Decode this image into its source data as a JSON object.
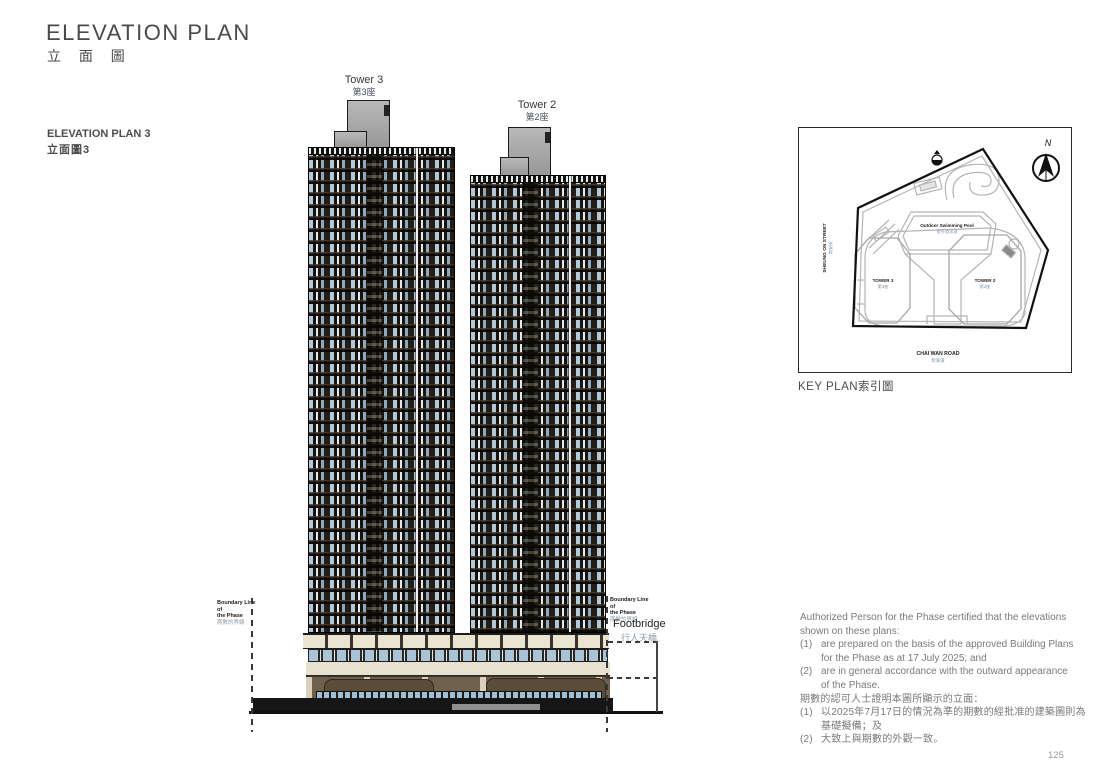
{
  "page": {
    "title": "ELEVATION PLAN",
    "title_zh": "立 面 圖",
    "plan_label": "ELEVATION PLAN 3",
    "plan_label_zh": "立面圖3",
    "page_number": "125"
  },
  "elevation": {
    "tower3": {
      "name": "Tower 3",
      "name_zh": "第3座"
    },
    "tower2": {
      "name": "Tower 2",
      "name_zh": "第2座"
    },
    "boundary_left": {
      "line1": "Boundary Line of",
      "line2": "the Phase",
      "zh": "期數的界線"
    },
    "boundary_right": {
      "line1": "Boundary Line of",
      "line2": "the Phase",
      "zh": "期數的界線"
    },
    "footbridge": {
      "label": "Footbridge",
      "zh": "行人天橋"
    }
  },
  "key_plan": {
    "caption": "KEY PLAN索引圖",
    "north_label": "N",
    "pool": {
      "label": "Outdoor Swimming Pool",
      "zh": "室外游泳池"
    },
    "tower3": {
      "label": "TOWER 3",
      "zh": "第3座"
    },
    "tower2": {
      "label": "TOWER 2",
      "zh": "第2座"
    },
    "street_left": {
      "label": "SHEUNG ON STREET",
      "zh": "常安街"
    },
    "road_bottom": {
      "label": "CHAI WAN ROAD",
      "zh": "柴灣道"
    }
  },
  "certification": {
    "en_intro": [
      "Authorized Person for the Phase certified that the elevations",
      "shown on these plans:"
    ],
    "en_items": [
      {
        "num": "(1)",
        "lines": [
          "are prepared on the basis of the approved Building Plans",
          "for the Phase as at 17 July 2025; and"
        ]
      },
      {
        "num": "(2)",
        "lines": [
          "are in general accordance with the outward appearance",
          "of the Phase."
        ]
      }
    ],
    "zh_intro": "期數的認可人士證明本圖所顯示的立面：",
    "zh_items": [
      {
        "num": "(1)",
        "lines": [
          "以2025年7月17日的情況為準的期數的經批准的建築圖則為",
          "基礎擬備；及"
        ]
      },
      {
        "num": "(2)",
        "lines": [
          "大致上與期數的外觀一致。"
        ]
      }
    ]
  }
}
